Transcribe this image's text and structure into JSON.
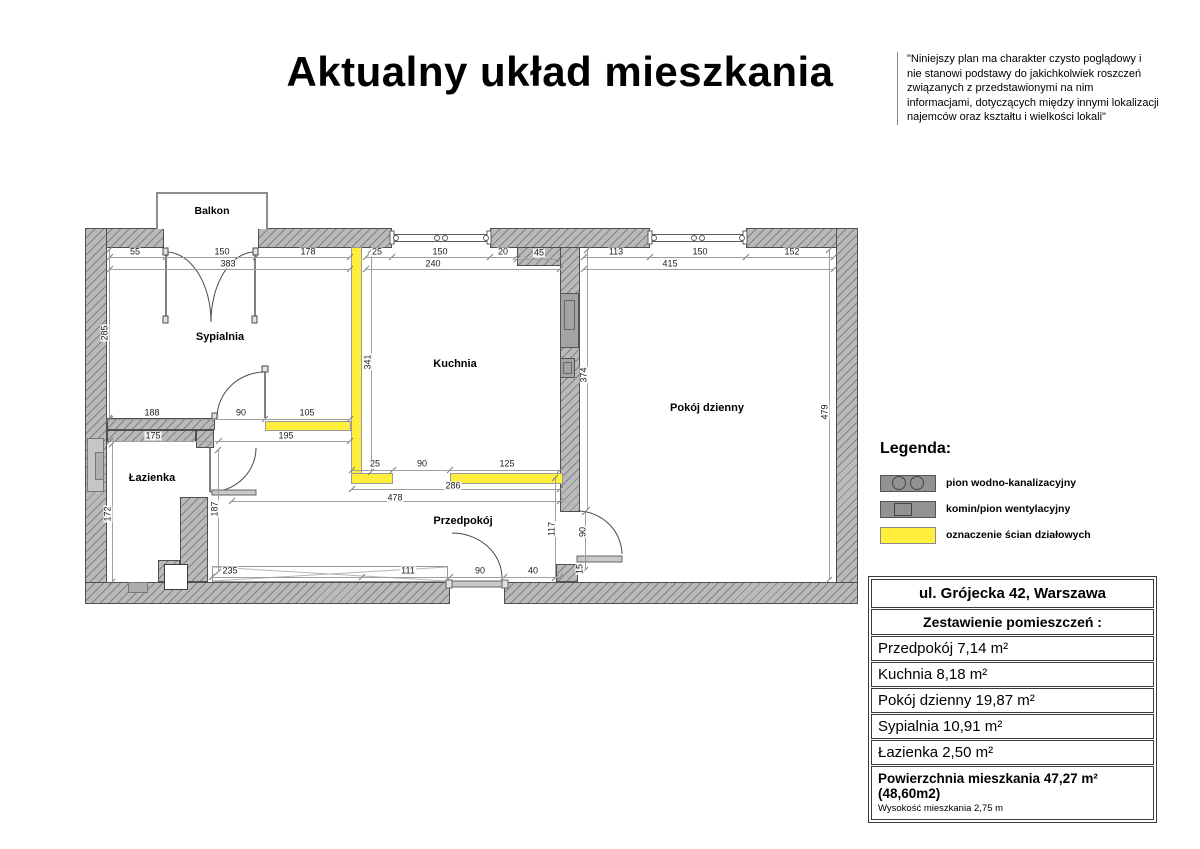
{
  "title": "Aktualny układ mieszkania",
  "disclaimer": "\"Niniejszy plan ma charakter czysto poglądowy i nie stanowi podstawy do jakichkolwiek roszczeń związanych z przedstawionymi na nim informacjami, dotyczących między innymi lokalizacji najemców oraz kształtu i wielkości lokali\"",
  "plan": {
    "rooms": {
      "balkon": "Balkon",
      "sypialnia": "Sypialnia",
      "kuchnia": "Kuchnia",
      "pokoj_dzienny": "Pokój dzienny",
      "lazienka": "Łazienka",
      "przedpokoj": "Przedpokój"
    },
    "dims": [
      "55",
      "150",
      "178",
      "383",
      "25",
      "150",
      "20",
      "45",
      "240",
      "113",
      "150",
      "152",
      "415",
      "285",
      "341",
      "374",
      "479",
      "172",
      "187",
      "117",
      "90",
      "15",
      "188",
      "90",
      "105",
      "175",
      "195",
      "25",
      "90",
      "125",
      "286",
      "478",
      "235",
      "111",
      "90",
      "40"
    ],
    "colors": {
      "wall_gray": "#bababa",
      "partition_yellow": "#ffee3c"
    }
  },
  "legend": {
    "heading": "Legenda:",
    "items": [
      {
        "symbol": "gray-box-two-circles",
        "label": "pion wodno-kanalizacyjny"
      },
      {
        "symbol": "gray-box-square",
        "label": "komin/pion wentylacyjny"
      },
      {
        "symbol": "yellow-box",
        "label": "oznaczenie ścian działowych"
      }
    ]
  },
  "summary_table": {
    "address": "ul. Grójecka 42, Warszawa",
    "heading": "Zestawienie pomieszczeń :",
    "rows": [
      "Przedpokój 7,14 m²",
      "Kuchnia 8,18 m²",
      "Pokój dzienny  19,87 m²",
      "Sypialnia 10,91 m²",
      "Łazienka 2,50 m²"
    ],
    "total": "Powierzchnia mieszkania 47,27 m² (48,60m2)",
    "height_note": "Wysokość mieszkania 2,75 m"
  }
}
